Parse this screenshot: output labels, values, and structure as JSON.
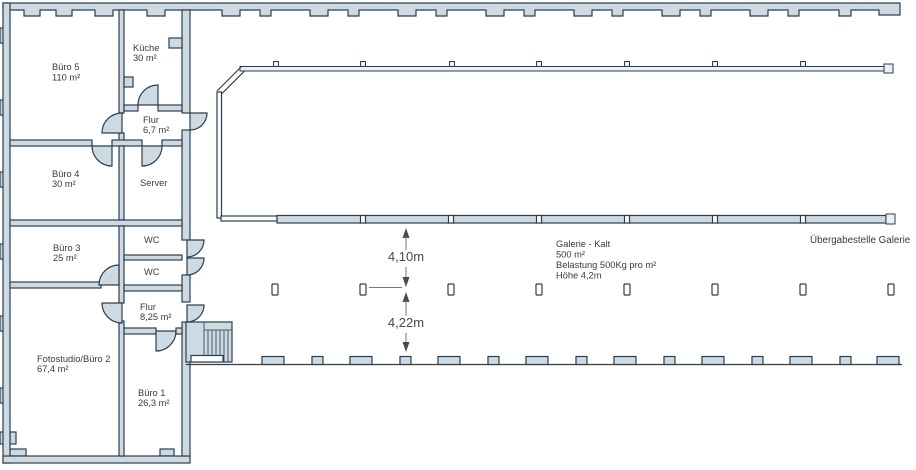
{
  "colors": {
    "wall_fill": "#cdd9e3",
    "line": "#2c3e4d",
    "text": "#3a3a3a",
    "dimension": "#4a4a4a"
  },
  "rooms": [
    {
      "name": "Büro 5",
      "area": "110 m²"
    },
    {
      "name": "Küche",
      "area": "30 m²"
    },
    {
      "name": "Flur",
      "area": "6,7 m²"
    },
    {
      "name": "Büro 4",
      "area": "30 m²"
    },
    {
      "name": "Server",
      "area": ""
    },
    {
      "name": "Büro 3",
      "area": "25 m²"
    },
    {
      "name": "WC",
      "area": ""
    },
    {
      "name": "WC",
      "area": ""
    },
    {
      "name": "Flur",
      "area": "8,25 m²"
    },
    {
      "name": "Fotostudio/Büro 2",
      "area": "67,4 m²"
    },
    {
      "name": "Büro 1",
      "area": "26,3 m²"
    }
  ],
  "hall": {
    "info_lines": {
      "l1": "Galerie - Kalt",
      "l2": "500 m²",
      "l3": "Belastung 500Kg pro m²",
      "l4": "Höhe 4,2m"
    },
    "handover_label": "Übergabestelle Galerie"
  },
  "dimensions": {
    "upper": "4,10m",
    "lower": "4,22m"
  }
}
